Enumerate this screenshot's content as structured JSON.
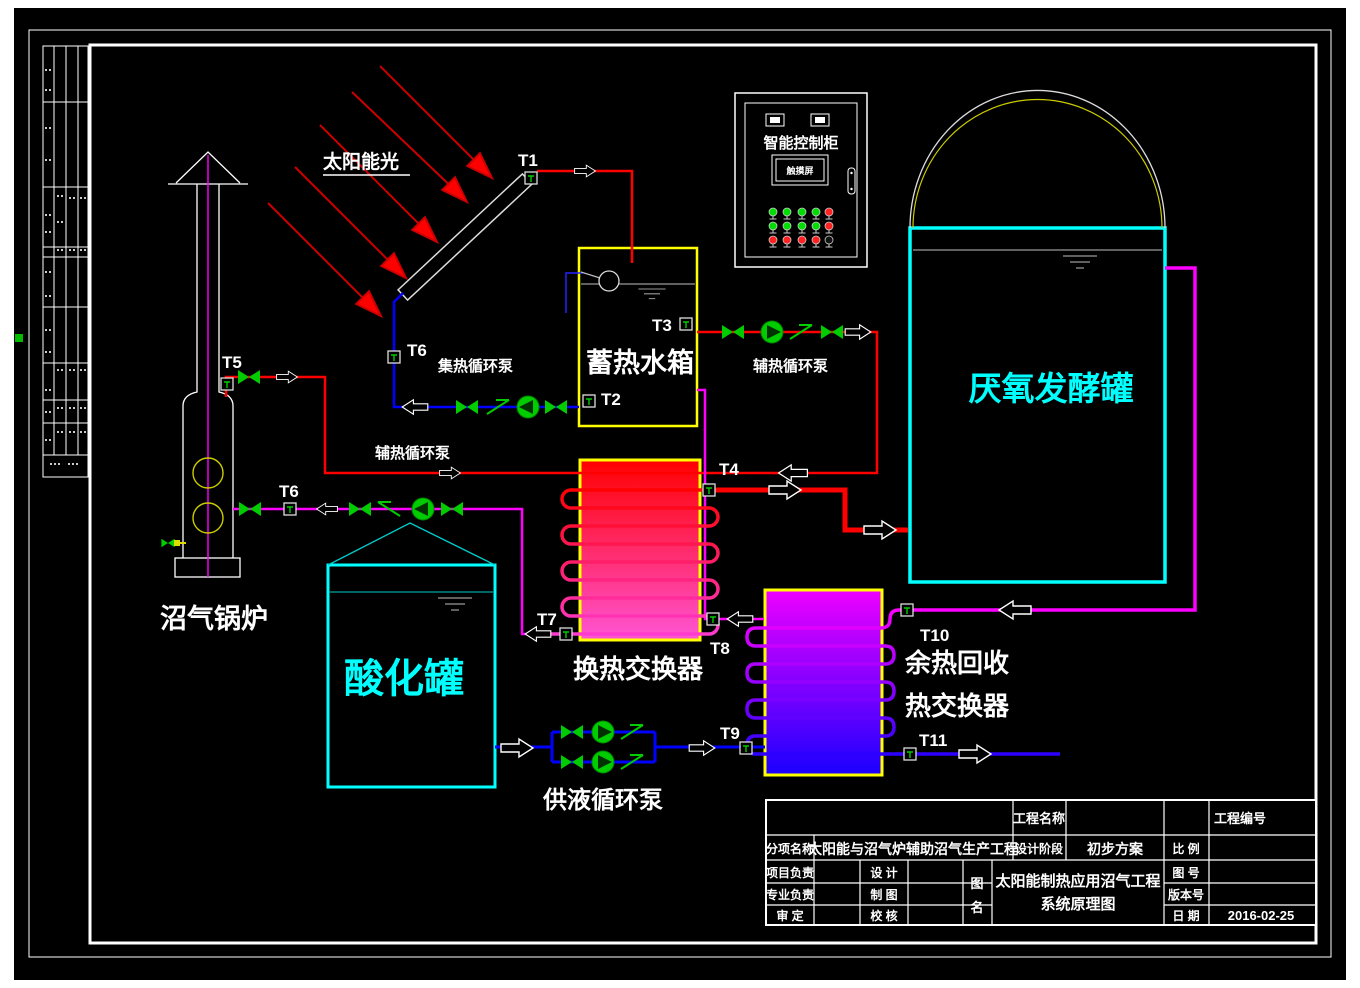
{
  "labels": {
    "solar_light": "太阳能光",
    "collector_pump": "集热循环泵",
    "storage_tank": "蓄热水箱",
    "aux_pump_left": "辅热循环泵",
    "aux_pump_right": "辅热循环泵",
    "heat_exchanger": "换热交换器",
    "waste_heat_line1": "余热回收",
    "waste_heat_line2": "热交换器",
    "supply_pump": "供液循环泵",
    "acid_tank": "酸化罐",
    "digester": "厌氧发酵罐",
    "boiler": "沼气锅炉",
    "control_cabinet": "智能控制柜",
    "touch_screen": "触摸屏"
  },
  "sensors": {
    "t1": "T1",
    "t2": "T2",
    "t3": "T3",
    "t4": "T4",
    "t5": "T5",
    "t6a": "T6",
    "t6b": "T6",
    "t7": "T7",
    "t8": "T8",
    "t9": "T9",
    "t10": "T10",
    "t11": "T11"
  },
  "title_block": {
    "project_name_label": "工程名称",
    "project_no_label": "工程编号",
    "sub_item_label": "分项名称",
    "sub_item_value": "太阳能与沼气炉辅助沼气生产工程",
    "design_stage_label": "设计阶段",
    "design_stage_value": "初步方案",
    "scale_label": "比  例",
    "project_lead_label": "项目负责",
    "design_label": "设  计",
    "drawing_no_label": "图  号",
    "discipline_lead_label": "专业负责",
    "draft_label": "制  图",
    "version_label": "版本号",
    "approve_label": "审  定",
    "check_label": "校  核",
    "date_label": "日  期",
    "date_value": "2016-02-25",
    "drawing_name_char1": "图",
    "drawing_name_char2": "名",
    "drawing_title_line1": "太阳能制热应用沼气工程",
    "drawing_title_line2": "系统原理图"
  },
  "control_cabinet": {
    "lights": [
      [
        "#00dd00",
        "#00dd00",
        "#00dd00",
        "#00dd00",
        "#ff2222"
      ],
      [
        "#00dd00",
        "#00dd00",
        "#00dd00",
        "#00dd00",
        "#ff2222"
      ],
      [
        "#ff2222",
        "#ff2222",
        "#ff2222",
        "#ff2222",
        "#111111"
      ]
    ]
  },
  "colors": {
    "background": "#000000",
    "frame_white": "#ffffff",
    "pipe_red": "#ff0000",
    "pipe_blue": "#0000ff",
    "pipe_magenta": "#ff00ff",
    "tank_cyan": "#00ffff",
    "box_yellow": "#ffff00",
    "valve_green": "#00cc00",
    "label_cyan": "#00ffff",
    "label_white": "#ffffff"
  }
}
